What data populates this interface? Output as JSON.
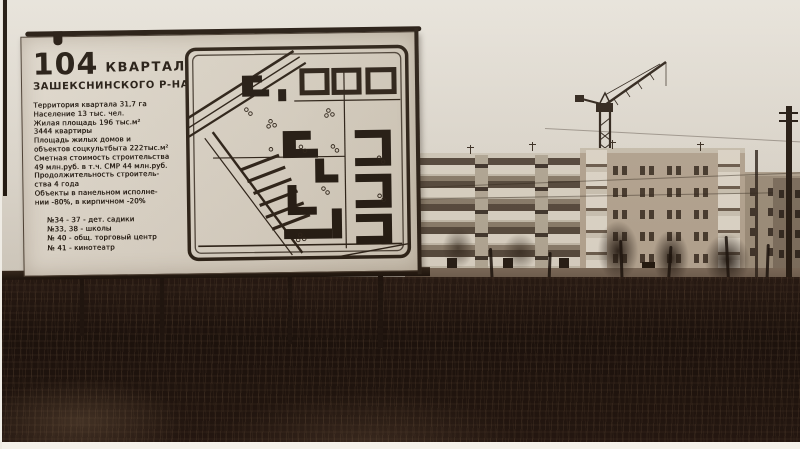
{
  "billboard": {
    "number": "104",
    "title": "КВАРТАЛ",
    "subtitle": "ЗАШЕКСНИНСКОГО  Р-НА",
    "stats": [
      "Территория квартала  31,7 га",
      "Население  13 тыс. чел.",
      "Жилая площадь  196 тыс.м²",
      "3444  квартиры",
      "Площадь жилых домов и",
      "объектов соцкультбыта  222тыс.м²",
      "Сметная стоимость строительства",
      "49 млн.руб. в т.ч. СМР  44 млн.руб.",
      "Продолжительность строитель-",
      "ства  4 года",
      "Объекты в панельном исполне-",
      "нии -80%,  в кирпичном -20%"
    ],
    "legend": [
      "№34 - 37   - дет. садики",
      "№33, 38  - школы",
      "№ 40 - общ. торговый  центр",
      "№ 41 - кинотеатр"
    ]
  },
  "colors": {
    "sky": "#e3ded6",
    "sign_background": "#d7d0c3",
    "sign_ink": "#241c14",
    "vegetation_dark": "#18100b",
    "field": "#7b6a5a",
    "panel_building": "#dad3c5",
    "brick_building": "#b4a592",
    "photo_border": "#f4f1ea"
  }
}
